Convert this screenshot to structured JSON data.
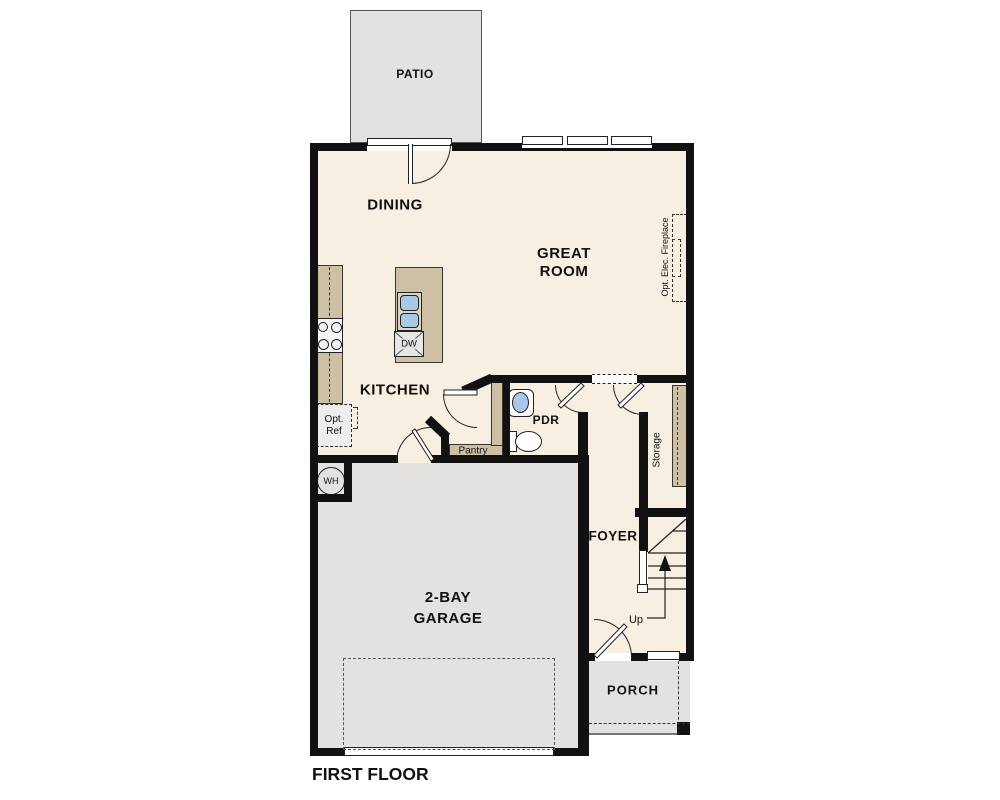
{
  "title": "FIRST FLOOR",
  "rooms": {
    "patio": "PATIO",
    "dining": "DINING",
    "great_room": {
      "line1": "GREAT",
      "line2": "ROOM"
    },
    "kitchen": "KITCHEN",
    "powder_room": "PDR",
    "pantry": "Pantry",
    "storage": "Storage",
    "foyer": "FOYER",
    "garage": {
      "line1": "2-BAY",
      "line2": "GARAGE"
    },
    "porch": "PORCH"
  },
  "annotations": {
    "optional_refrigerator": {
      "line1": "Opt.",
      "line2": "Ref"
    },
    "optional_fireplace": "Opt. Elec. Fireplace",
    "water_heater": "WH",
    "dishwasher": "DW",
    "stairs_up": "Up"
  },
  "colors": {
    "wall": "#111111",
    "floor": "#f7efe2",
    "concrete": "#e3e2e0",
    "cabinetry": "#cec0a4",
    "fixture_blue": "#a9c7e7"
  }
}
